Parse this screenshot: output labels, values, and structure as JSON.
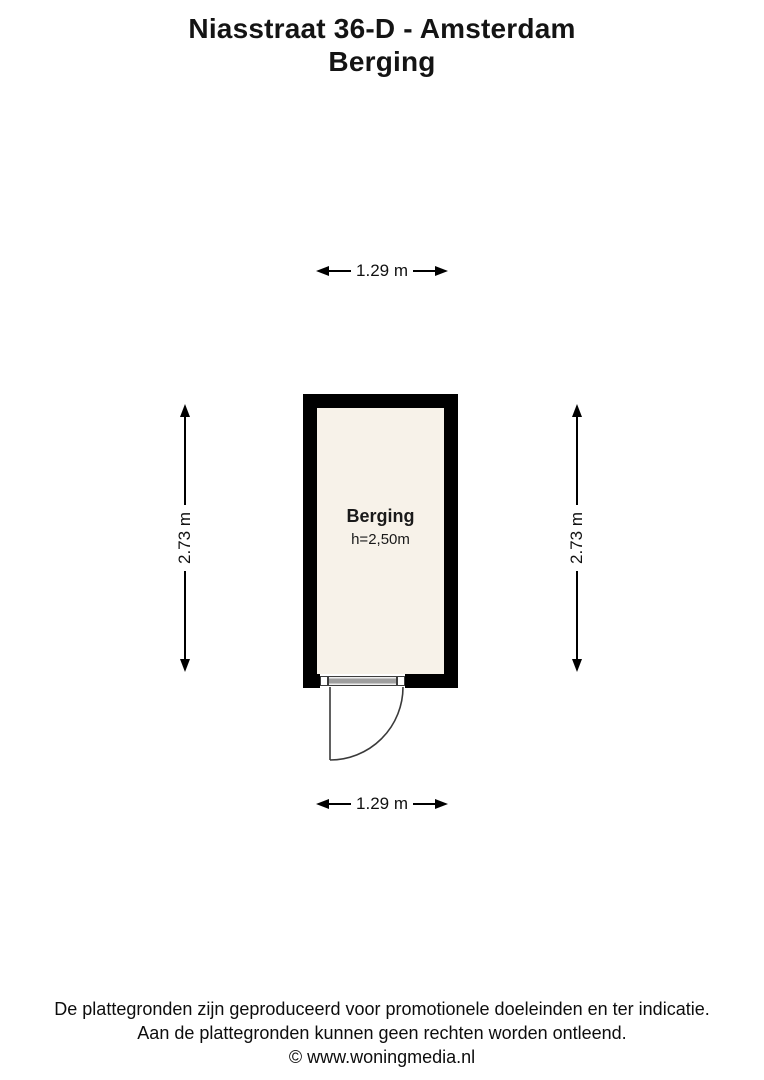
{
  "title": {
    "line1": "Niasstraat 36-D - Amsterdam",
    "line2": "Berging"
  },
  "plan": {
    "room": {
      "name": "Berging",
      "ceiling_height_label": "h=2,50m"
    },
    "dimensions": {
      "width_top": "1.29 m",
      "width_bottom": "1.29 m",
      "height_left": "2.73 m",
      "height_right": "2.73 m"
    }
  },
  "colors": {
    "wall": "#000000",
    "floor": "#f7f2e9",
    "line": "#3a3a3a"
  },
  "footer": {
    "line1": "De plattegronden zijn geproduceerd voor promotionele doeleinden en ter indicatie.",
    "line2": "Aan de plattegronden kunnen geen rechten worden ontleend.",
    "line3": "© www.woningmedia.nl"
  }
}
